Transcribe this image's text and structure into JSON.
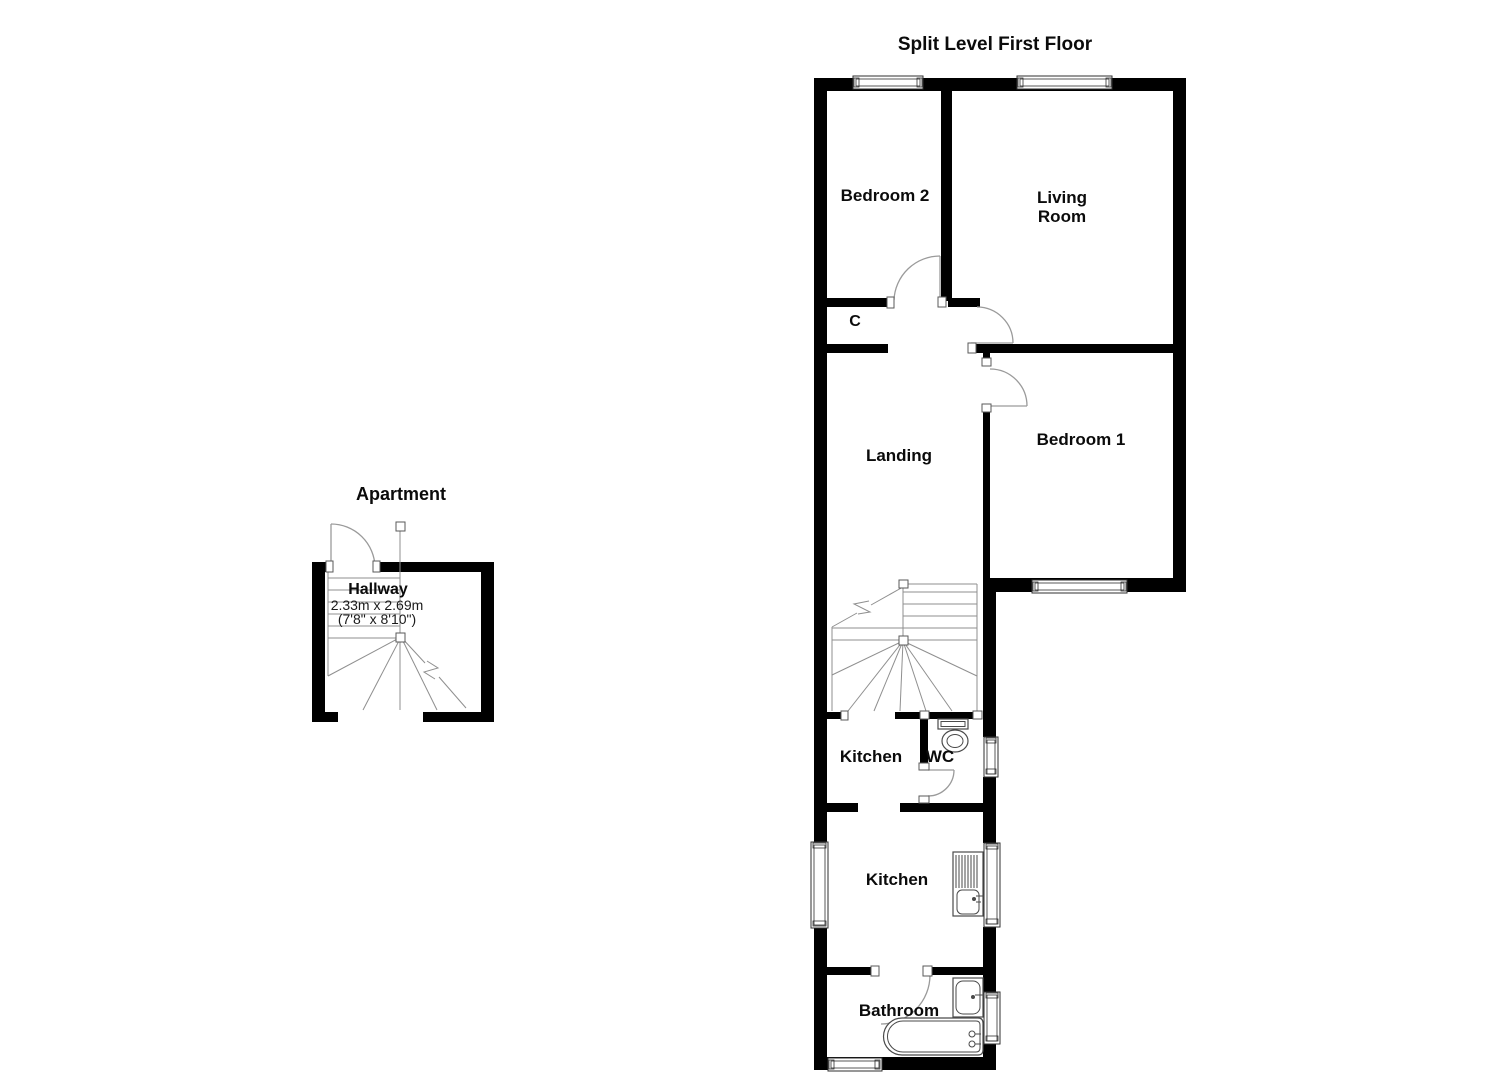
{
  "colors": {
    "background": "#ffffff",
    "wall": "#000000",
    "thin_line": "#8f8f8f",
    "text": "#0b0b0b"
  },
  "first_floor": {
    "title": "Split Level First Floor",
    "rooms": {
      "bedroom2": "Bedroom 2",
      "living_line1": "Living",
      "living_line2": "Room",
      "closet": "C",
      "landing": "Landing",
      "bedroom1": "Bedroom 1",
      "kitchen_upper": "Kitchen",
      "wc": "WC",
      "kitchen_lower": "Kitchen",
      "bathroom": "Bathroom"
    }
  },
  "apartment": {
    "title": "Apartment",
    "rooms": {
      "hallway": "Hallway",
      "hallway_size_metric": "2.33m x 2.69m",
      "hallway_size_imperial": "(7'8\" x 8'10\")"
    }
  }
}
